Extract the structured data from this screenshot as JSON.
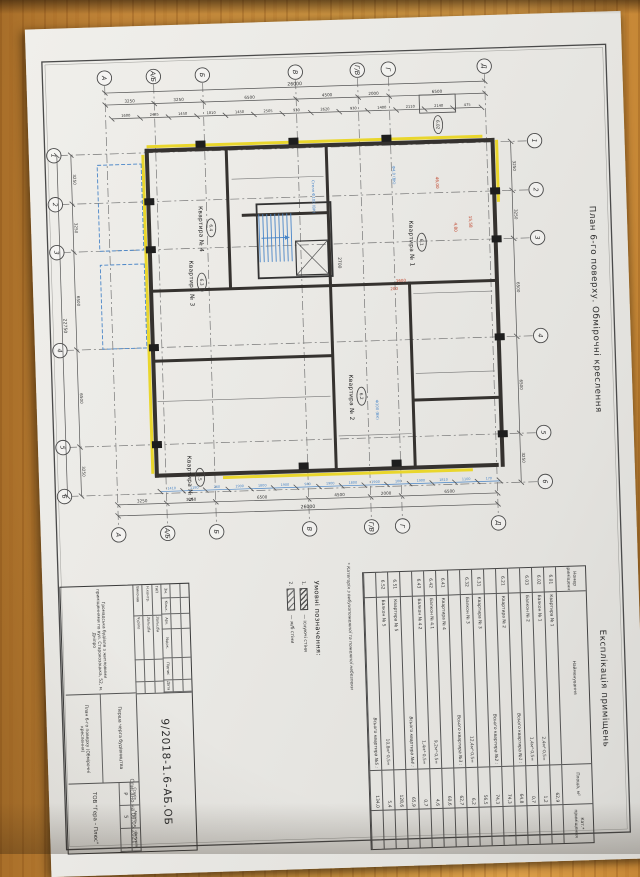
{
  "page": {
    "background_wood": "#c08438",
    "paper": "#eae9e5",
    "line": "#3c3c3c",
    "accent_yellow": "#e9d62c",
    "accent_blue": "#4a86c8",
    "accent_red": "#c0432a"
  },
  "sheet": {
    "drawing_title": "План 6-го поверху. Обмірочні креслення",
    "stamp_note": "Списано на 06.05.2021",
    "plan": {
      "number_axes": [
        "1",
        "2",
        "3",
        "4",
        "5",
        "6"
      ],
      "letter_axes": [
        "А",
        "А/Б",
        "Б",
        "В",
        "Г/В",
        "Г",
        "Д"
      ],
      "number_axis_chain": [
        "3250",
        "3250",
        "6500",
        "6500",
        "3250"
      ],
      "number_axis_total": "22750",
      "letter_axis_chain": [
        "3250",
        "3250",
        "6500",
        "4500",
        "2000",
        "6500"
      ],
      "letter_axis_total": "26000",
      "small_dims_left": [
        "1600",
        "2485",
        "1450",
        "1810",
        "1450",
        "2505",
        "930",
        "2620",
        "930",
        "1400",
        "2110",
        "2140",
        "475"
      ],
      "small_dims_right_blue": [
        "1410",
        "1180",
        "260",
        "1900",
        "1800",
        "1900",
        "940",
        "1900",
        "1800",
        "1900",
        "100",
        "1900",
        "1810",
        "1100",
        "170"
      ],
      "stair_dim": "2700",
      "rooms": [
        {
          "tag": "6.1",
          "label": "Квартира № 1"
        },
        {
          "tag": "6.2",
          "label": "Квартира № 2"
        },
        {
          "tag": "6.3",
          "label": "Квартира № 3"
        },
        {
          "tag": "6.4",
          "label": "Квартира № 4"
        },
        {
          "tag": "6.5",
          "label": "Квартира № 5"
        }
      ],
      "balcony_tag": "6.02",
      "red_notes": [
        "46,00",
        "15,58",
        "4,80",
        "1600",
        "200"
      ],
      "blue_notes": [
        "Стеля Ф100 (ВК)",
        "Ф100 (ВК)",
        "Ф4,0 (ВК)"
      ]
    },
    "legend": {
      "title": "Умовні позначення:",
      "items": [
        {
          "num": "1.",
          "label": "існуючі стіни"
        },
        {
          "num": "2.",
          "label": "ж/б стіни"
        }
      ]
    },
    "table": {
      "title": "Експлікація приміщень",
      "headers": [
        "Номер приміщення",
        "Найменування",
        "Площа, м²",
        "Кат.* приміщення"
      ],
      "rows": [
        [
          "6.01",
          "Квартира № 1",
          "",
          "62,9"
        ],
        [
          "6.02",
          "Балкон № 1",
          "2,4м²·0,5=",
          "1,2"
        ],
        [
          "6.03",
          "Балкон № 2",
          "1,4м²·0,5=",
          "0,7"
        ],
        [
          "",
          "Всього квартира №1 :",
          "",
          "64,8"
        ],
        [
          "6.21",
          "Квартира № 2",
          "",
          "74,3"
        ],
        [
          "",
          "Всього квартира №2 :",
          "",
          "74,3"
        ],
        [
          "6.31",
          "Квартира № 3",
          "",
          "56,5"
        ],
        [
          "6.32",
          "Балкон № 3",
          "12,4м²·0,5=",
          "6,2"
        ],
        [
          "",
          "Всього квартира №3 :",
          "",
          "62,7"
        ],
        [
          "6.41",
          "Квартира № 4",
          "",
          "60,6"
        ],
        [
          "6.42",
          "Балкон № 4.1",
          "9,2м²·0,5=",
          "4,6"
        ],
        [
          "6.43",
          "Балкон № 4.2",
          "1,4м²·0,5=",
          "0,7"
        ],
        [
          "",
          "Всього квартира №4 :",
          "",
          "65,9"
        ],
        [
          "6.51",
          "Квартира № 5",
          "",
          "128,6"
        ],
        [
          "6.52",
          "Балкон № 5",
          "10,8м²·0,5=",
          "5,4"
        ],
        [
          "",
          "Всього квартира №5 :",
          "",
          "134,0"
        ]
      ],
      "footnote": "* Категорія з вибухопожежної та пожежної небезпеки"
    },
    "titleblock": {
      "doc_number": "9/2018-1.6-АБ.ОБ",
      "project": "Громадська будівля з житловими приміщеннями по вул. Старокозацька, 52, м. Дніпро",
      "phase": "Перша черга будівництва",
      "sheet_name": "План 6-го поверху (Обмірочні креслення)",
      "rev_headers": [
        "Зм.",
        "Кільк.",
        "Арк.",
        "№док.",
        "Підпис",
        "Дата"
      ],
      "sign_rows": [
        {
          "role": "ГАП",
          "name": "Зальцба"
        },
        {
          "role": "Н.контр.",
          "name": "Зальцба"
        },
        {
          "role": "Виконав",
          "name": "Чуріло"
        }
      ],
      "stage_headers": [
        "Стадія",
        "Аркуш",
        "Аркушів"
      ],
      "stage": "Р",
      "sheet_no": "5",
      "sheets_total": "",
      "company": "ТОВ \"Гера – Плюс\""
    }
  }
}
